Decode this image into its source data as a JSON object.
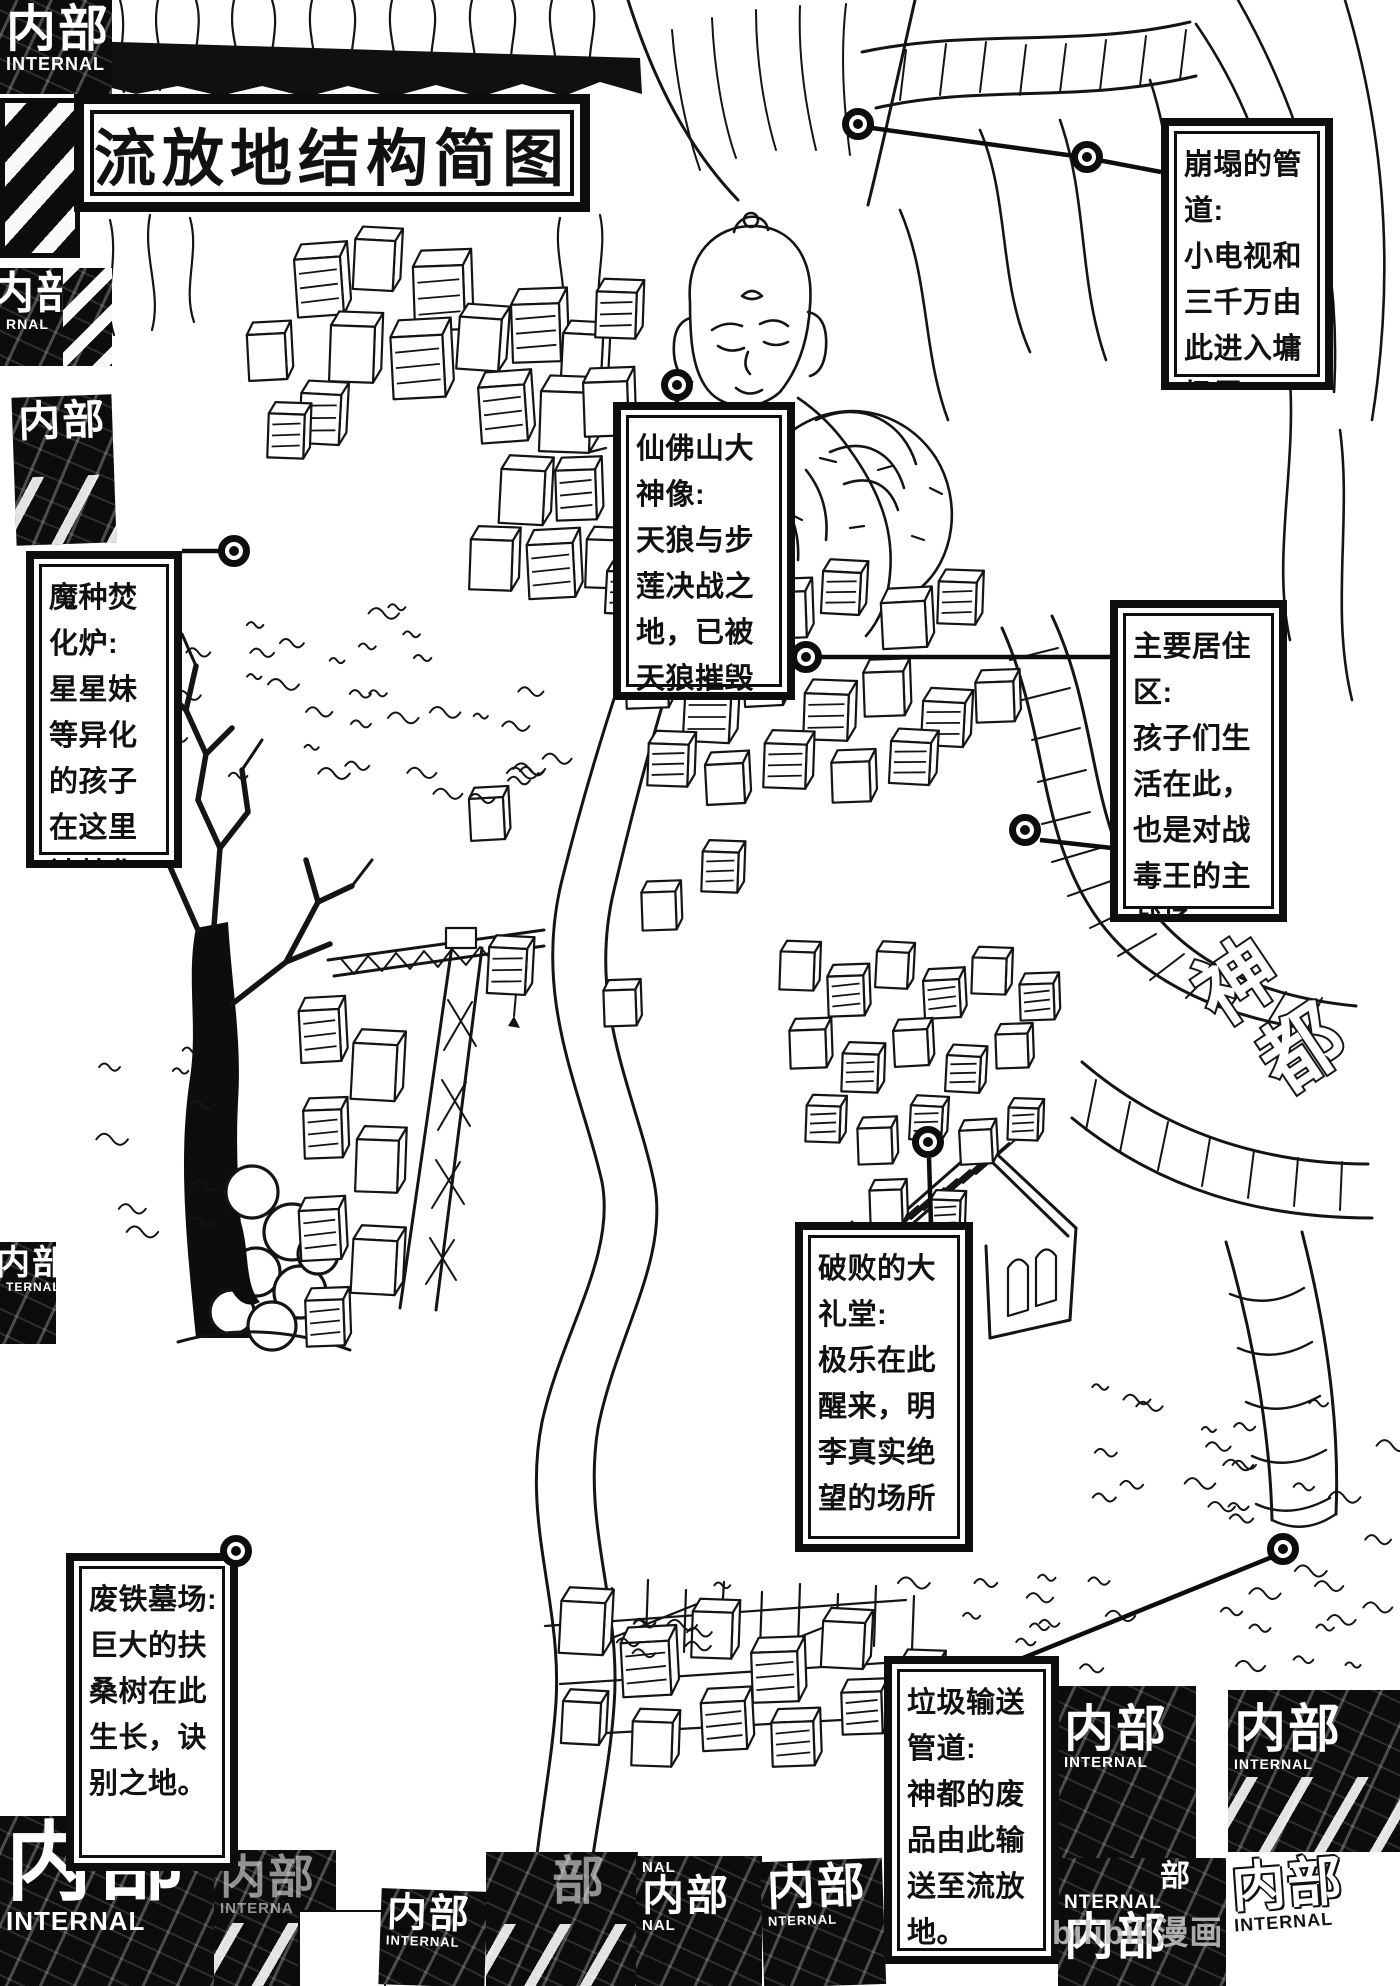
{
  "page": {
    "title": "流放地结构简图",
    "watermark": "bilibili漫画"
  },
  "stamps": {
    "cn": "内部",
    "en": "INTERNAL",
    "fragments": {
      "rnal": "RNAL",
      "nal": "NAL",
      "nternal": "NTERNAL",
      "interna": "INTERNA",
      "ternal": "TERNAL",
      "bu": "部"
    }
  },
  "graffiti": {
    "char1": "神",
    "char2": "都"
  },
  "callouts": [
    {
      "id": "collapsed-pipe",
      "title": "崩塌的管道:",
      "body": "小电视和三千万由此进入墉圾层。"
    },
    {
      "id": "incinerator",
      "title": "魔种焚化炉:",
      "body": "星星妹等异化的孩子在这里被焚化。"
    },
    {
      "id": "buddha-statue",
      "title": "仙佛山大神像:",
      "body": "天狼与步莲决战之地，已被天狼摧毁。"
    },
    {
      "id": "residential",
      "title": "主要居住区:",
      "body": "孩子们生活在此，也是对战毒王的主战场。"
    },
    {
      "id": "grand-hall",
      "title": "破败的大礼堂:",
      "body": "极乐在此醒来，明李真实绝望的场所。"
    },
    {
      "id": "scrap-graveyard",
      "title": "废铁墓场:",
      "body": "巨大的扶桑树在此生长，诀别之地。"
    },
    {
      "id": "garbage-pipe",
      "title": "垃圾输送管道:",
      "body": "神都的废品由此输送至流放地。"
    }
  ],
  "markers": [
    {
      "id": "collapsed-pipe-a",
      "x": 858,
      "y": 124
    },
    {
      "id": "collapsed-pipe-b",
      "x": 1087,
      "y": 157
    },
    {
      "id": "incinerator",
      "x": 234,
      "y": 551
    },
    {
      "id": "buddha-statue",
      "x": 677,
      "y": 385
    },
    {
      "id": "residential-a",
      "x": 806,
      "y": 657
    },
    {
      "id": "residential-b",
      "x": 1025,
      "y": 830
    },
    {
      "id": "grand-hall",
      "x": 928,
      "y": 1142
    },
    {
      "id": "scrap-graveyard",
      "x": 236,
      "y": 1551
    },
    {
      "id": "garbage-pipe",
      "x": 1283,
      "y": 1549
    }
  ]
}
